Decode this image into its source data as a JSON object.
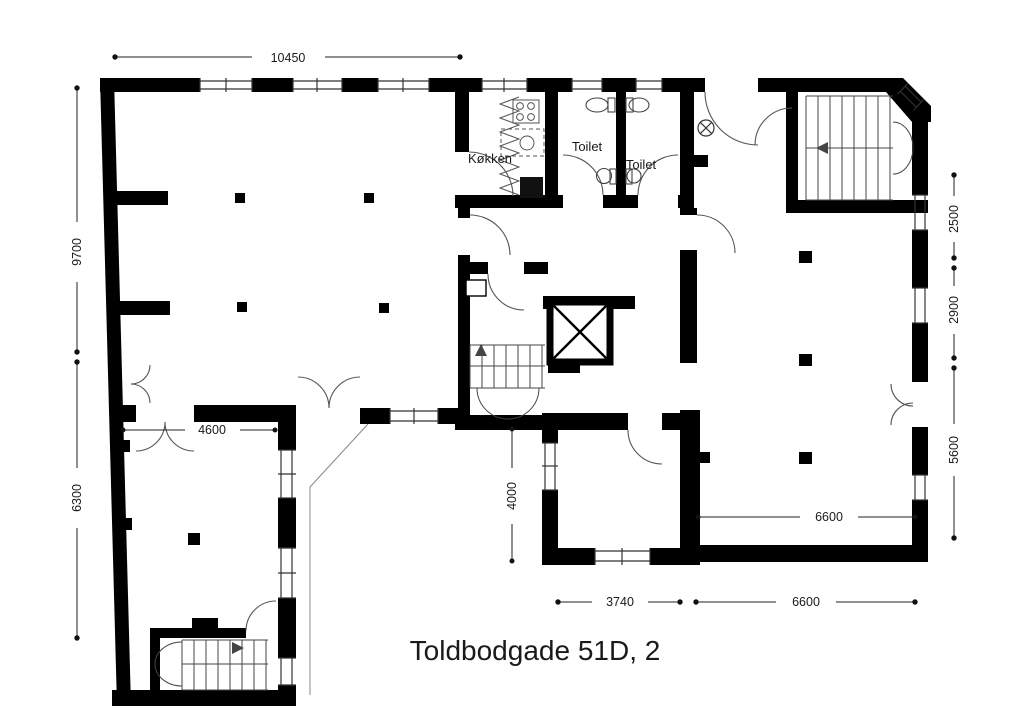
{
  "title": "Toldbodgade 51D, 2",
  "rooms": {
    "kitchen": "Køkken",
    "toilet_left": "Toilet",
    "toilet_right": "Toilet"
  },
  "dimensions": {
    "top": "10450",
    "left_upper": "9700",
    "left_lower": "6300",
    "room_bottom_left": "4600",
    "center_vertical": "4000",
    "bottom_center": "3740",
    "bottom_right": "6600",
    "right_room_inner": "6600",
    "right_upper": "2500",
    "right_middle": "2900",
    "right_lower": "5600"
  }
}
